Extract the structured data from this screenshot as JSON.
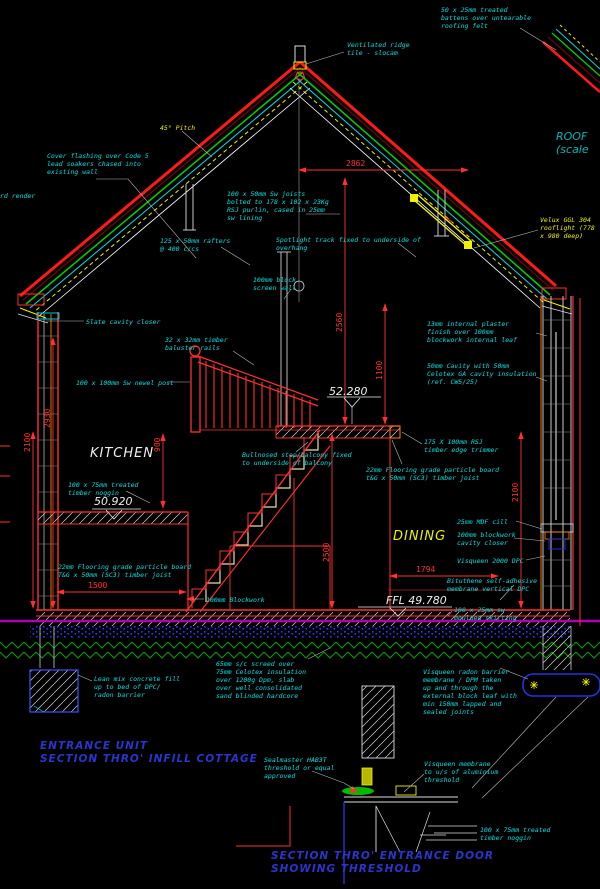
{
  "colors": {
    "background": "#000000",
    "annotation_cyan": "#00e0e0",
    "dimension_red": "#ff3030",
    "highlight_yellow": "#f0f000",
    "text_white": "#f0f0f0",
    "title_blue": "#2a35cc",
    "roof_green": "#00d000",
    "dpc_magenta": "#b000b0",
    "detail_blue": "#2233dd",
    "ground_hatch_green": "#00a000",
    "wall_orange": "#ff8000"
  },
  "labels": {
    "roof_felt": "50 x 25mm treated\nbattens over untearable\nroofing felt",
    "ridge": "Ventilated ridge\ntile - slocam",
    "pitch": "45° Pitch",
    "flashing": "Cover flashing over Code 5\nlead soakers chased into\nexisting wall",
    "render_partial": "rd render",
    "rsj_purlin": "100 x 50mm Sw joists\nbolted to 178 x 102 x 23Kg\nRSJ purlin, cased in 25mm\nsw lining",
    "rafters": "125 x 50mm rafters\n@ 400 c/cs",
    "track": "Spotlight track fixed to underside of\noverhang",
    "screen_wall": "100mm block\nscreen wall",
    "velux": "Velux GGL 304\nrooflight (778\nx 980 deep)",
    "roof_title": "ROOF\n(scale",
    "plaster": "13mm internal plaster\nfinish over 100mm\nblockwork internal leaf",
    "cavity": "50mm Cavity with 50mm\nCelotex GA cavity insulation\n(ref. CW5/25)",
    "slate": "Slate cavity closer",
    "baluster": "32 x 32mm timber\nbaluster rails",
    "newel": "100 x 100mm Sw newel post",
    "level_52": "52.280",
    "kitchen": "KITCHEN",
    "noggin1": "100 x 75mm treated\ntimber noggin",
    "level_50": "50.920",
    "bullnose": "Bullnosed step/balcony fixed\nto underside of balcony",
    "trimmer": "175 X 100mm RSJ\ntimber edge trimmer",
    "floor_upper": "22mm Flooring grade particle board\nt&G x 50mm (SC3) timber joist",
    "dining": "DINING",
    "mdf": "25mm MDF cill",
    "closer": "100mm blockwork\ncavity closer",
    "visqueen2000": "Visqueen 2000 DPC",
    "bituthene": "Bituthene self-adhesive\nmembrane vertical DPC",
    "floor_lower": "22mm Flooring grade particle board\nT&G x 50mm (SC3) timber joist",
    "blockwork": "100mm Blockwork",
    "ffl": "FFL 49.780",
    "skirting": "100 x 25mm sw\nmoulded skirting",
    "leanmix": "Lean mix concrete fill\nup to bed of DPC/\nradon barrier",
    "screed": "65mm s/c screed over\n75mm Celotex insulation\nover 1200g Dpm, slab\nover well consolidated\nsand blinded hardcore",
    "radon": "Visqueen radon barrier\nmembrane / DPM taken\nup and through the\nexternal block leaf with\nmin 150mm lapped and\nsealed joints",
    "entrance_title": "ENTRANCE UNIT\nSECTION THRO' INFILL COTTAGE",
    "sealmaster": "Sealmaster HAB3T\nthreshold or equal\napproved",
    "visqueen_thresh": "Visqueen membrane\nto u/s of aluminium\nthreshold",
    "door_title": "SECTION THRO' ENTRANCE DOOR\nSHOWING THRESHOLD",
    "noggin2": "100 x 75mm treated\ntimber noggin"
  },
  "dims": {
    "d2862": "2862",
    "d2560": "2560",
    "d1100": "1100",
    "d2930": "2930",
    "d2100l": "2100",
    "d900": "900",
    "d2500": "2500",
    "d2100r": "2100",
    "d1794": "1794",
    "d1500": "1500"
  }
}
